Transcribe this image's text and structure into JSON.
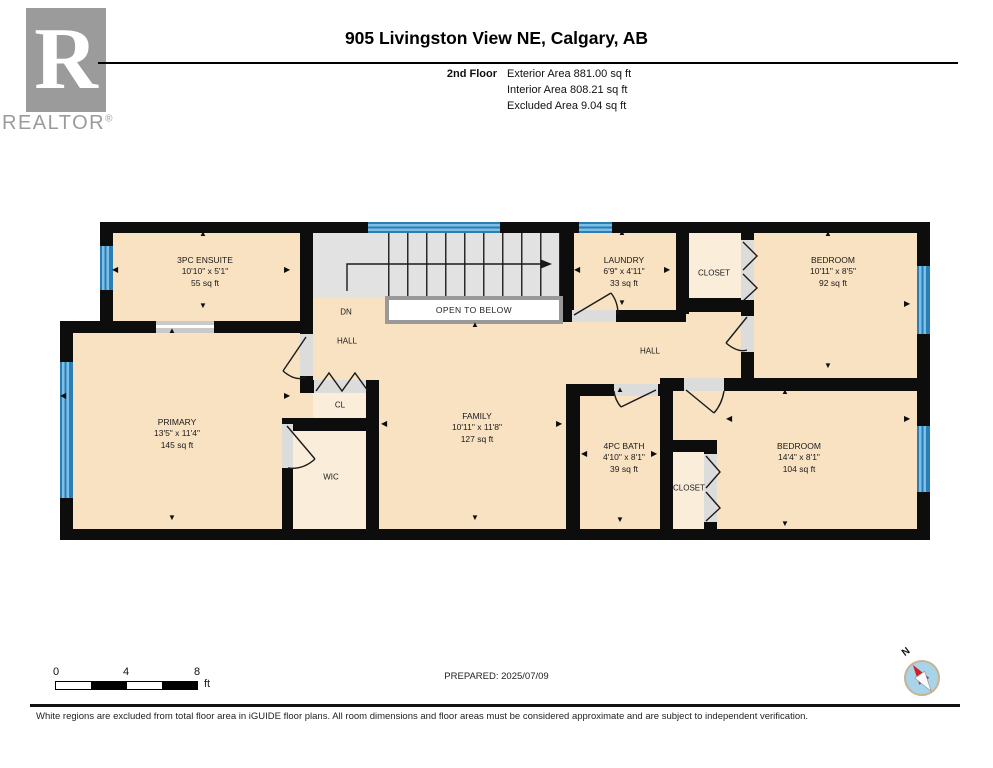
{
  "header": {
    "title": "905 Livingston View NE, Calgary, AB",
    "floor_label": "2nd Floor",
    "exterior_area": "Exterior Area 881.00 sq ft",
    "interior_area": "Interior Area 808.21 sq ft",
    "excluded_area": "Excluded Area 9.04 sq ft"
  },
  "logo": {
    "letter": "R",
    "brand": "REALTOR",
    "registered": "®"
  },
  "rooms": {
    "ensuite": {
      "name": "3PC ENSUITE",
      "dims": "10'10\" x 5'1\"",
      "area": "55 sq ft"
    },
    "laundry": {
      "name": "LAUNDRY",
      "dims": "6'9\" x 4'11\"",
      "area": "33 sq ft"
    },
    "closet_top": {
      "name": "CLOSET"
    },
    "bedroom_top": {
      "name": "BEDROOM",
      "dims": "10'11\" x 8'5\"",
      "area": "92 sq ft"
    },
    "primary": {
      "name": "PRIMARY",
      "dims": "13'5\" x 11'4\"",
      "area": "145 sq ft"
    },
    "cl": {
      "name": "CL"
    },
    "wic": {
      "name": "WIC"
    },
    "family": {
      "name": "FAMILY",
      "dims": "10'11\" x 11'8\"",
      "area": "127 sq ft"
    },
    "bath": {
      "name": "4PC BATH",
      "dims": "4'10\" x 8'1\"",
      "area": "39 sq ft"
    },
    "closet_bottom": {
      "name": "CLOSET"
    },
    "bedroom_bottom": {
      "name": "BEDROOM",
      "dims": "14'4\" x 8'1\"",
      "area": "104 sq ft"
    },
    "hall_left": {
      "name": "HALL"
    },
    "hall_right": {
      "name": "HALL"
    },
    "dn": {
      "name": "DN"
    },
    "open_to_below": {
      "name": "OPEN TO BELOW"
    }
  },
  "scale_bar": {
    "tick_0": "0",
    "tick_4": "4",
    "tick_8": "8",
    "unit": "ft"
  },
  "compass": {
    "north_label": "N"
  },
  "footer": {
    "prepared": "PREPARED: 2025/07/09",
    "disclaimer": "White regions are excluded from total floor area in iGUIDE floor plans. All room dimensions and floor areas must be considered approximate and are subject to independent verification."
  },
  "colors": {
    "room_fill": "#f8e2c2",
    "closet_fill": "#faeedb",
    "stairs_fill": "#e2e2e2",
    "wall": "#0d0d0d",
    "window": "#6cb5e2",
    "window_frame": "#2d7db5",
    "door_gap": "#dcdcdc",
    "open_to_below_frame": "#999999"
  }
}
